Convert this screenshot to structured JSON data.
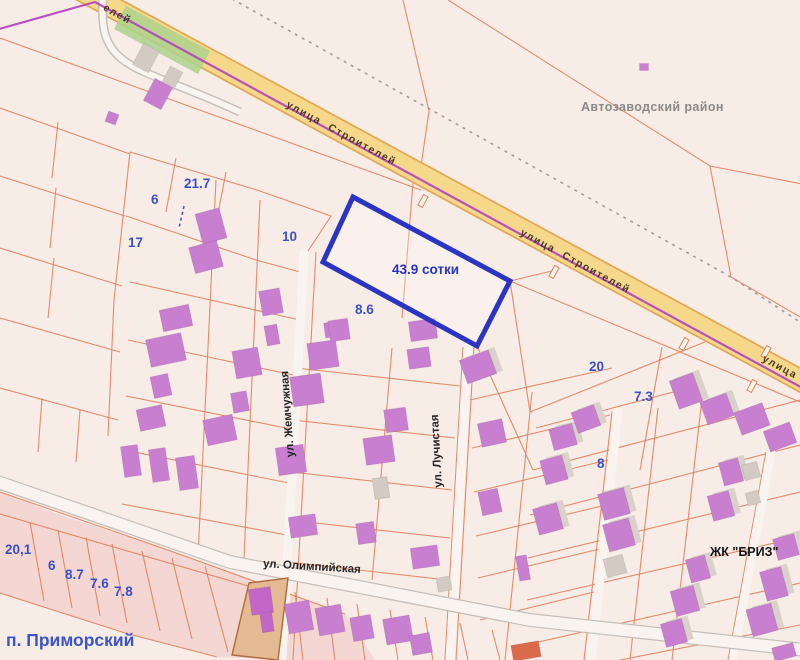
{
  "map": {
    "district_label": "Автозаводский район",
    "settlement_label": "п. Приморский",
    "residential_complex_label": "ЖК \"БРИЗ\"",
    "highlighted_plot": {
      "area_label": "43.9 сотки"
    },
    "street_labels": {
      "stroiteley_upper": "улица Строителей",
      "stroiteley_lower": "улица Строителей",
      "stroiteley_fragment_topleft": "елей",
      "stroiteley_fragment_right": "улица Ст",
      "zhemchuzhnaya": "ул. Жемчужная",
      "luchistaya": "ул. Лучистая",
      "olimpiyskaya": "ул. Олимпийская"
    },
    "parcel_labels": [
      {
        "text": "21.7"
      },
      {
        "text": "6"
      },
      {
        "text": "17"
      },
      {
        "text": "10"
      },
      {
        "text": "8.6"
      },
      {
        "text": "20"
      },
      {
        "text": "7.3"
      },
      {
        "text": "8"
      },
      {
        "text": "20,1"
      },
      {
        "text": "6"
      },
      {
        "text": "8.7"
      },
      {
        "text": "7.6"
      },
      {
        "text": "7.8"
      }
    ],
    "colors": {
      "background": "#f8ece7",
      "parcel_line": "#e0815c",
      "road_fill": "#f6d88a",
      "road_casing": "#e2a855",
      "boundary_line": "#b448c0",
      "dashed_boundary": "#a39d99",
      "minor_road": "#faf4f0",
      "minor_road_casing": "#c6c0ba",
      "building": "#c87fd0",
      "building_gray": "#d3cac3",
      "building_shadow": "#d9d1ca",
      "building_orange": "#d96a4a",
      "building_dark": "#c267c8",
      "tan_parcel": "#e4ba92",
      "tan_parcel_border": "#b06a3a",
      "highlight_blue": "#2a35c4",
      "label_blue": "#3a50c8",
      "green_area": "#abd28c",
      "settlement_band": "#f3d4cf"
    }
  }
}
